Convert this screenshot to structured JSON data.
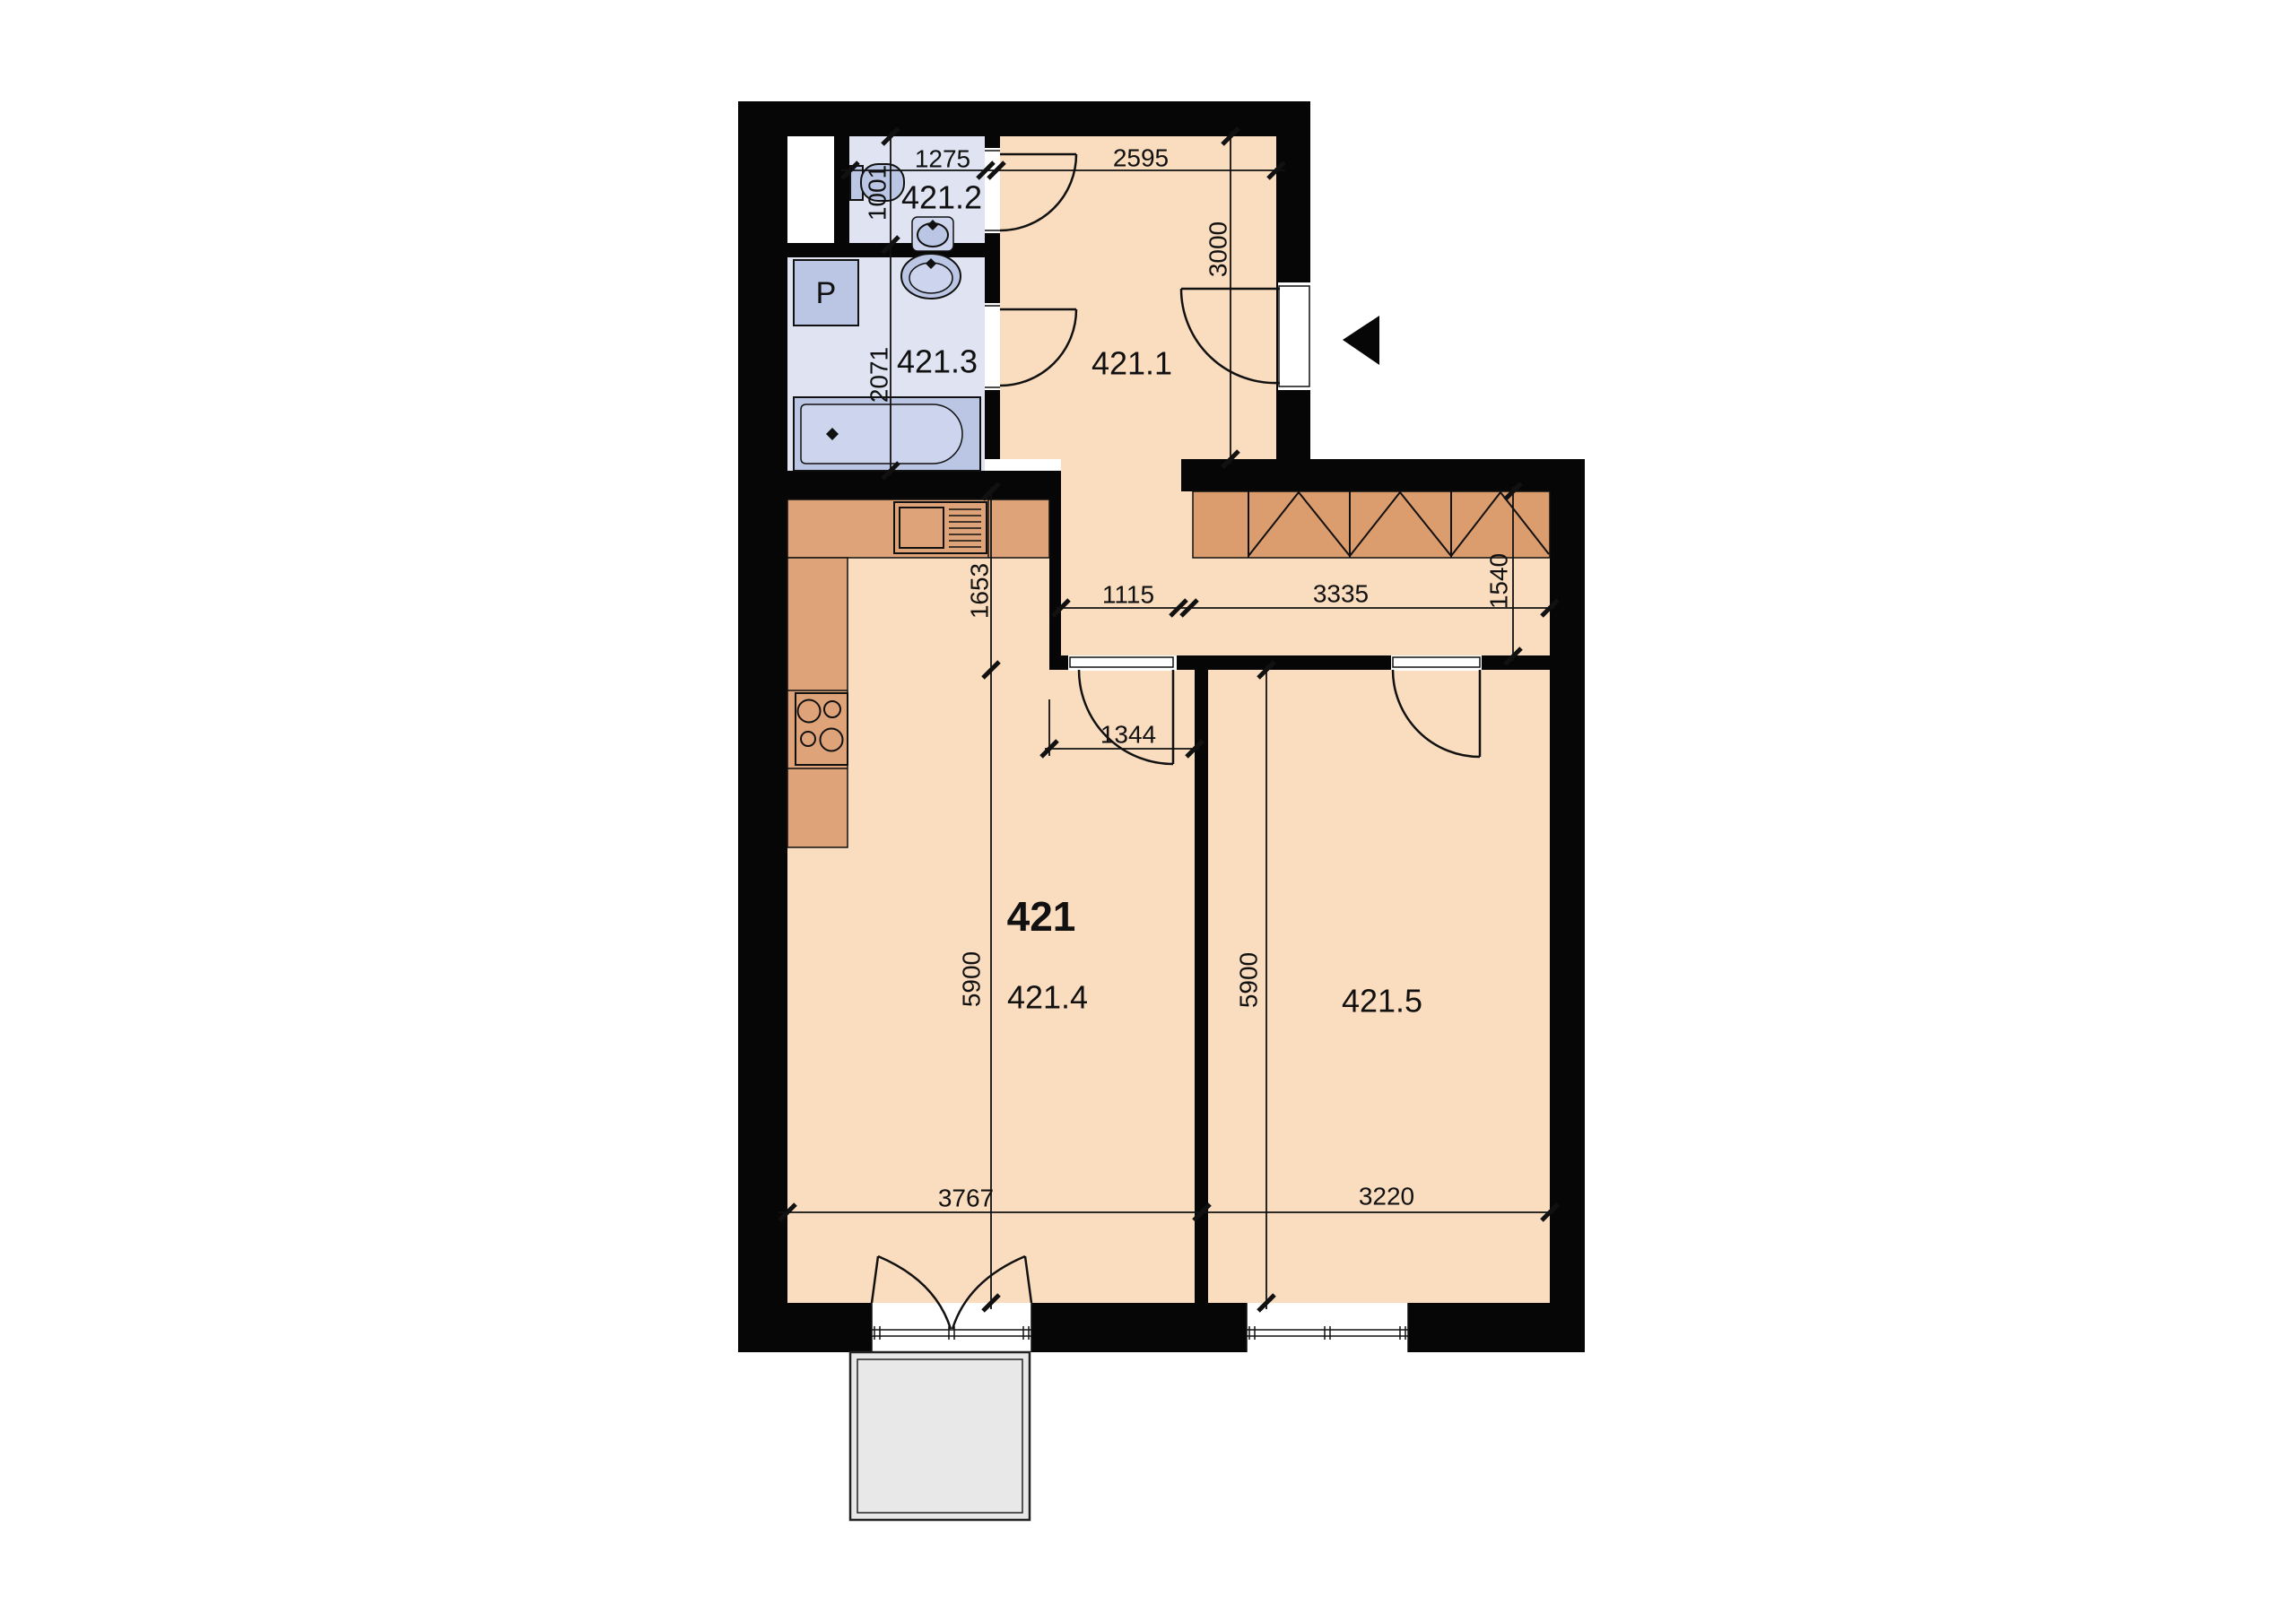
{
  "unit": {
    "number": "421"
  },
  "rooms": {
    "r1": {
      "label": "421.1"
    },
    "r2": {
      "label": "421.2"
    },
    "r3": {
      "label": "421.3"
    },
    "r4": {
      "label": "421.4"
    },
    "r5": {
      "label": "421.5"
    }
  },
  "appliances": {
    "washer_label": "P"
  },
  "dims": {
    "wc_width": "1275",
    "hall_width": "2595",
    "wc_depth": "1001",
    "hall_depth": "3000",
    "bath_depth": "2071",
    "kitchen_depth": "1653",
    "passage_width": "1115",
    "corridor_width": "3335",
    "corridor_depth": "1540",
    "room4_door": "1344",
    "room4_depth": "5900",
    "room5_depth": "5900",
    "room4_width": "3767",
    "room5_width": "3220"
  },
  "colors": {
    "wall": "#060606",
    "floor_main": "#fadcbf",
    "floor_bathroom": "#e0e4f2",
    "kitchen_counter": "#dfa37a",
    "wardrobe": "#db9c6e",
    "fixtures": "#bac6e4",
    "balcony": "#e8e8e8"
  }
}
